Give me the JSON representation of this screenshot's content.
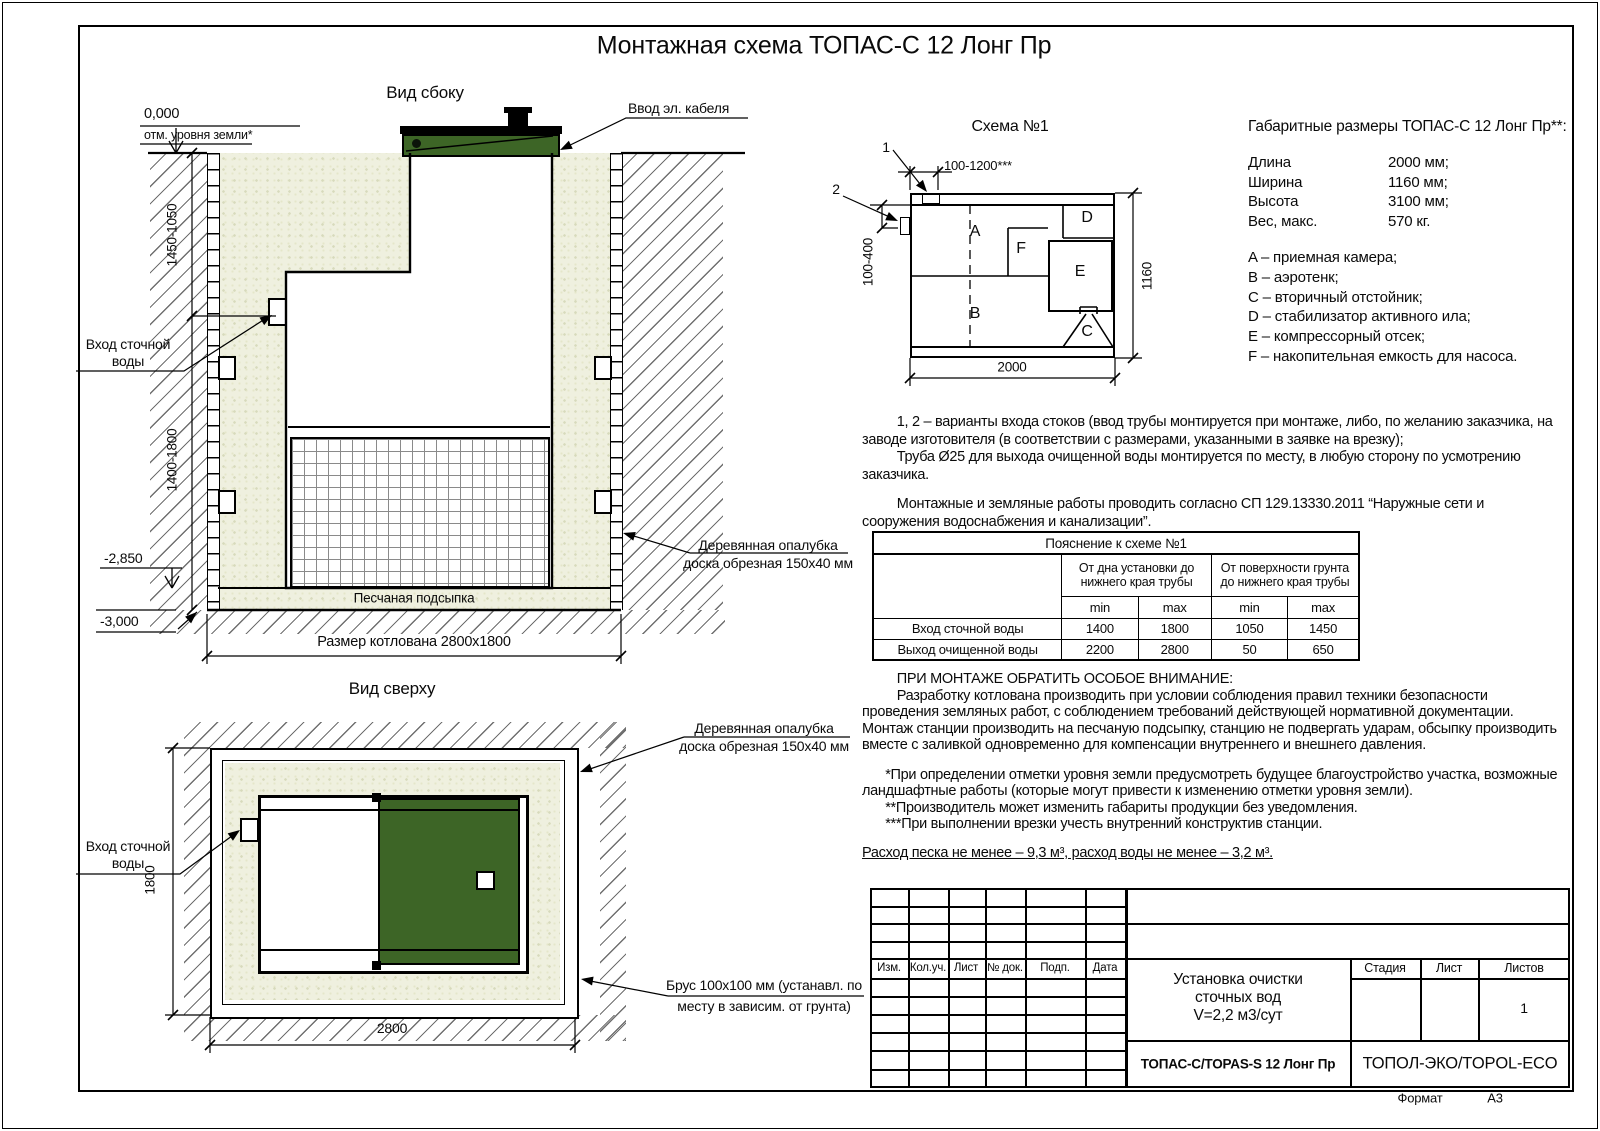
{
  "page": {
    "title": "Монтажная схема ТОПАС-С 12 Лонг Пр"
  },
  "side_view": {
    "label": "Вид сбоку",
    "cable_label": "Ввод эл. кабеля",
    "zero_level": "0,000",
    "ground_note": "отм. уровня земли*",
    "dim_upper": "1450-1050",
    "dim_lower": "1400-1800",
    "inlet_line1": "Вход сточной",
    "inlet_line2": "воды",
    "level_unit_bottom": "-2,850",
    "level_pit_bottom": "-3,000",
    "sand_label": "Песчаная подсыпка",
    "pit_dim_label": "Размер котлована 2800х1800",
    "formwork_line1": "Деревянная опалубка",
    "formwork_line2": "доска обрезная 150х40 мм"
  },
  "top_view": {
    "label": "Вид сверху",
    "formwork_line1": "Деревянная опалубка",
    "formwork_line2": "доска обрезная 150х40 мм",
    "inlet_line1": "Вход сточной",
    "inlet_line2": "воды",
    "dim_width_label": "2800",
    "dim_height_label": "1800",
    "brus_line1": "Брус 100х100 мм (устанавл. по",
    "brus_line2": "месту в зависим. от грунта)"
  },
  "schema": {
    "title": "Схема №1",
    "marker_1": "1",
    "marker_2": "2",
    "dim_top": "100-1200***",
    "dim_left": "100-400",
    "dim_right": "1160",
    "dim_bottom": "2000",
    "comp_a": "A",
    "comp_b": "B",
    "comp_c": "C",
    "comp_d": "D",
    "comp_e": "E",
    "comp_f": "F"
  },
  "specs": {
    "title": "Габаритные размеры ТОПАС-С 12 Лонг Пр**:",
    "rows": [
      {
        "label": "Длина",
        "value": "2000 мм;"
      },
      {
        "label": "Ширина",
        "value": "1160 мм;"
      },
      {
        "label": "Высота",
        "value": "3100 мм;"
      },
      {
        "label": "Вес, макс.",
        "value": "570 кг."
      }
    ],
    "legend": [
      "A – приемная камера;",
      "B – аэротенк;",
      "C – вторичный отстойник;",
      "D – стабилизатор активного ила;",
      "E – компрессорный отсек;",
      "F – накопительная емкость для насоса."
    ]
  },
  "notes": {
    "para1": "1, 2 – варианты входа  стоков (ввод трубы монтируется при монтаже, либо, по желанию заказчика, на заводе изготовителя (в соответствии с размерами, указанными в заявке на врезку);",
    "para2": "Труба Ø25 для выхода очищенной воды монтируется по месту, в любую сторону по усмотрению заказчика.",
    "para3": "Монтажные и земляные работы проводить согласно СП 129.13330.2011 “Наружные сети и сооружения водоснабжения и канализации”."
  },
  "explain_table": {
    "title": "Пояснение к схеме №1",
    "group1": "От дна установки до нижнего края трубы",
    "group2": "От поверхности грунта до нижнего края трубы",
    "min_label": "min",
    "max_label": "max",
    "rows": [
      {
        "label": "Вход сточной воды",
        "v1": "1400",
        "v2": "1800",
        "v3": "1050",
        "v4": "1450"
      },
      {
        "label": "Выход очищенной воды",
        "v1": "2200",
        "v2": "2800",
        "v3": "50",
        "v4": "650"
      }
    ]
  },
  "attention": {
    "heading": "ПРИ МОНТАЖЕ ОБРАТИТЬ ОСОБОЕ ВНИМАНИЕ:",
    "body": "Разработку котлована производить при условии соблюдения правил техники безопасности проведения земляных работ, с соблюдением требований действующей нормативной документации. Монтаж станции производить на песчаную подсыпку, станцию не подвергать ударам, обсыпку производить вместе с заливкой одновременно для компенсации внутреннего и внешнего давления.",
    "footnote1": "*При определении отметки уровня земли предусмотреть будущее благоустройство участка, возможные ландшафтные работы (которые могут привести к изменению отметки уровня земли).",
    "footnote2": "**Производитель может изменить габариты продукции без уведомления.",
    "footnote3": "***При выполнении врезки учесть внутренний конструктив станции.",
    "consumption": "Расход песка не менее – 9,3 м³, расход воды не менее – 3,2 м³."
  },
  "stamp": {
    "col_izm": "Изм.",
    "col_koluch": "Кол.уч.",
    "col_list": "Лист",
    "col_doc": "№ док.",
    "col_podp": "Подп.",
    "col_data": "Дата",
    "title_line1": "Установка очистки",
    "title_line2": "сточных вод",
    "title_line3": "V=2,2 м3/сут",
    "stage_label": "Стадия",
    "sheet_label": "Лист",
    "sheets_label": "Листов",
    "sheets_value": "1",
    "model": "ТОПАС-С/TOPAS-S 12 Лонг Пр",
    "company": "ТОПОЛ-ЭКО/TOPOL-ECO",
    "format_label": "Формат",
    "format_value": "А3"
  },
  "colors": {
    "green": "#3d6526",
    "sand_base": "#eff0df"
  }
}
